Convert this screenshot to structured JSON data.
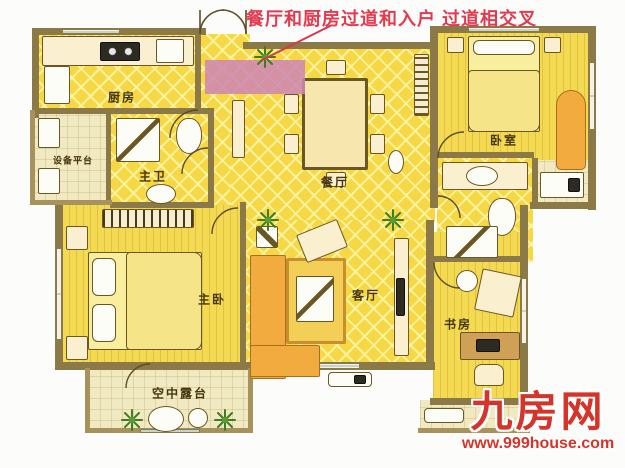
{
  "annotation": {
    "text": "餐厅和厨房过道和入户 过道相交叉",
    "color": "#e23a50"
  },
  "rooms": {
    "kitchen": {
      "label": "厨房"
    },
    "equipment_platform": {
      "label": "设备平台"
    },
    "master_bathroom": {
      "label": "主卫"
    },
    "dining_room": {
      "label": "餐厅"
    },
    "bedroom": {
      "label": "卧室"
    },
    "master_bedroom": {
      "label": "主卧"
    },
    "living_room": {
      "label": "客厅"
    },
    "study": {
      "label": "书房"
    },
    "sky_terrace": {
      "label": "空中露台"
    }
  },
  "branding": {
    "site_name": "九房网",
    "site_url": "www.999house.com",
    "color": "#d5342b"
  },
  "colors": {
    "wall": "#8b7947",
    "floor_yellow": "#f6d846",
    "floor_pale": "#f1e9c2",
    "highlight_pink": "#cf86b2",
    "annotation_red": "#e23a50"
  }
}
